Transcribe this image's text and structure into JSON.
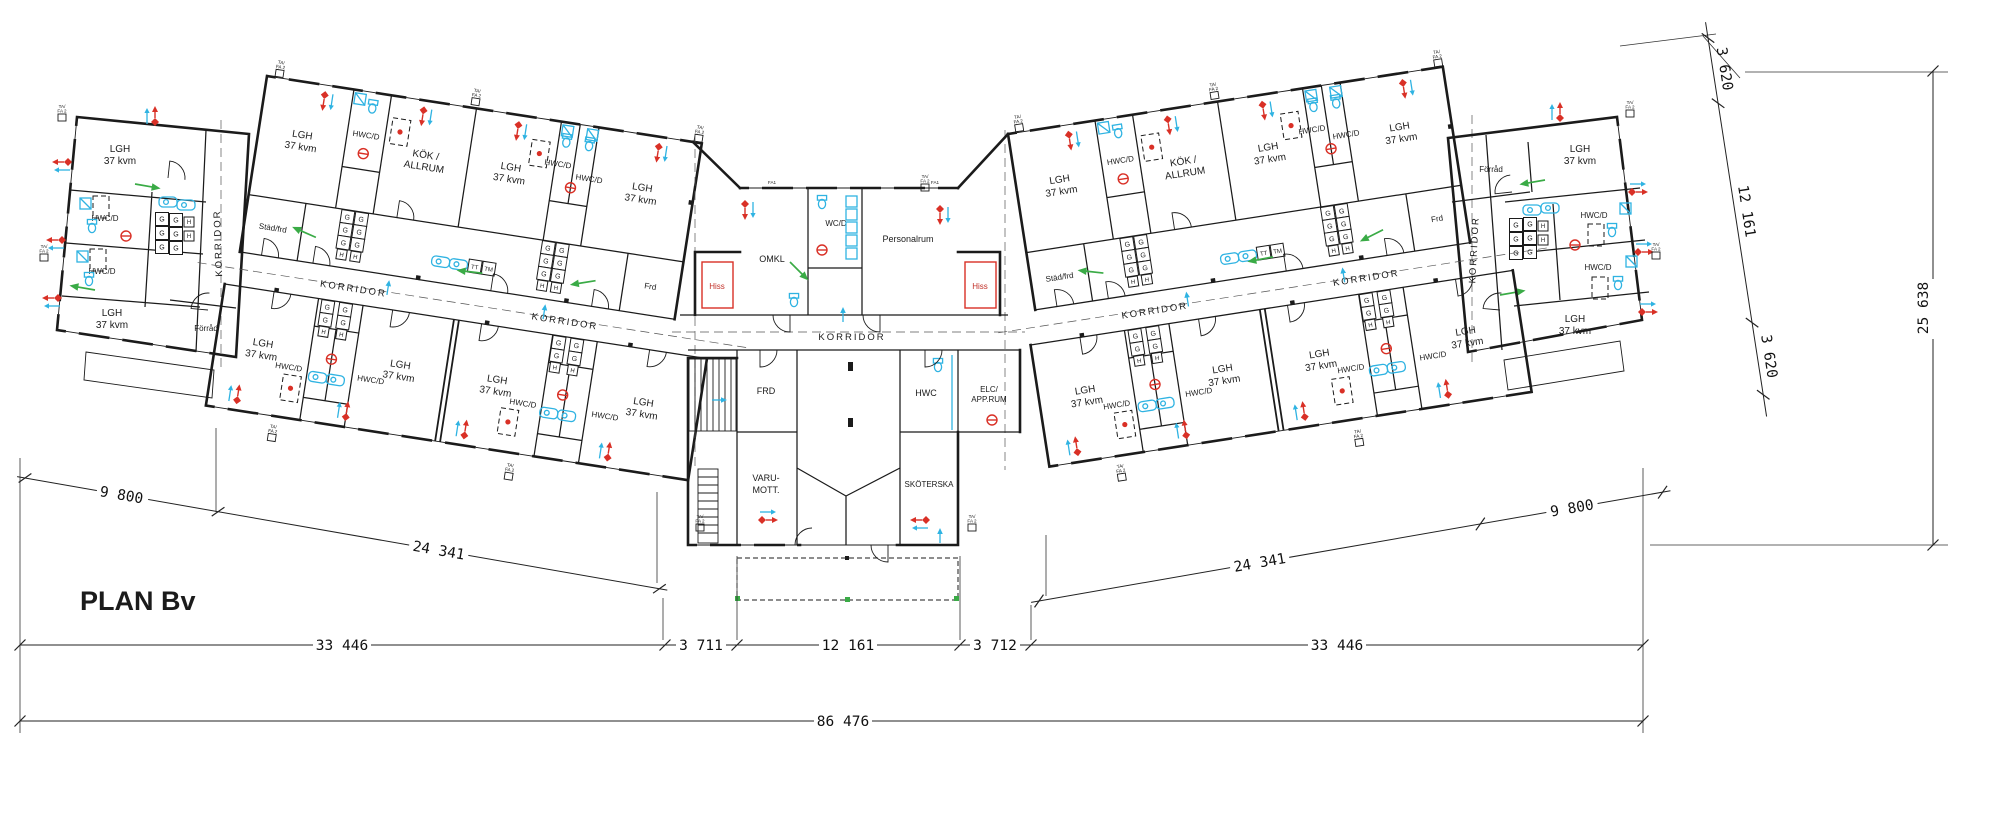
{
  "title": "PLAN Bv",
  "drawing_type": "floor-plan",
  "labels": {
    "lgh_line1": "LGH",
    "lgh_line2": "37 kvm",
    "hwcd": "HWC/D",
    "hwc": "HWC",
    "wcd": "WC/D",
    "kok_line1": "KÖK /",
    "kok_line2": "ALLRUM",
    "korridor": "KORRIDOR",
    "stadfrd": "Städ/frd",
    "forrad": "Förråd",
    "frd": "Frd",
    "frd_caps": "FRD",
    "hiss": "Hiss",
    "omkl": "OMKL",
    "personalrum": "Personalrum",
    "elc_line1": "ELC/",
    "elc_line2": "APP.RUM",
    "varu_line1": "VARU-",
    "varu_line2": "MOTT.",
    "skoterska": "SKÖTERSKA",
    "g": "G",
    "h": "H",
    "tt": "TT",
    "tm": "TM",
    "tafa_line1": "TA/",
    "tafa_line2": "FA 2",
    "fa": "FA1"
  },
  "dims": {
    "left_diagonal": [
      "9 800",
      "24 341"
    ],
    "right_diagonal": [
      "24 341",
      "9 800"
    ],
    "bottom_chain": [
      "33 446",
      "3 711",
      "12 161",
      "3 712",
      "33 446"
    ],
    "overall_width": "86 476",
    "right_chain": [
      "3 620",
      "12 161",
      "3 620"
    ],
    "overall_depth": "25 638"
  },
  "colors": {
    "walls": "#1b1b1b",
    "alarm_red": "#d93026",
    "plumbing_cyan": "#2fb3e2",
    "exit_green": "#3aab46",
    "elevator_red": "#c23028",
    "background": "#ffffff"
  }
}
